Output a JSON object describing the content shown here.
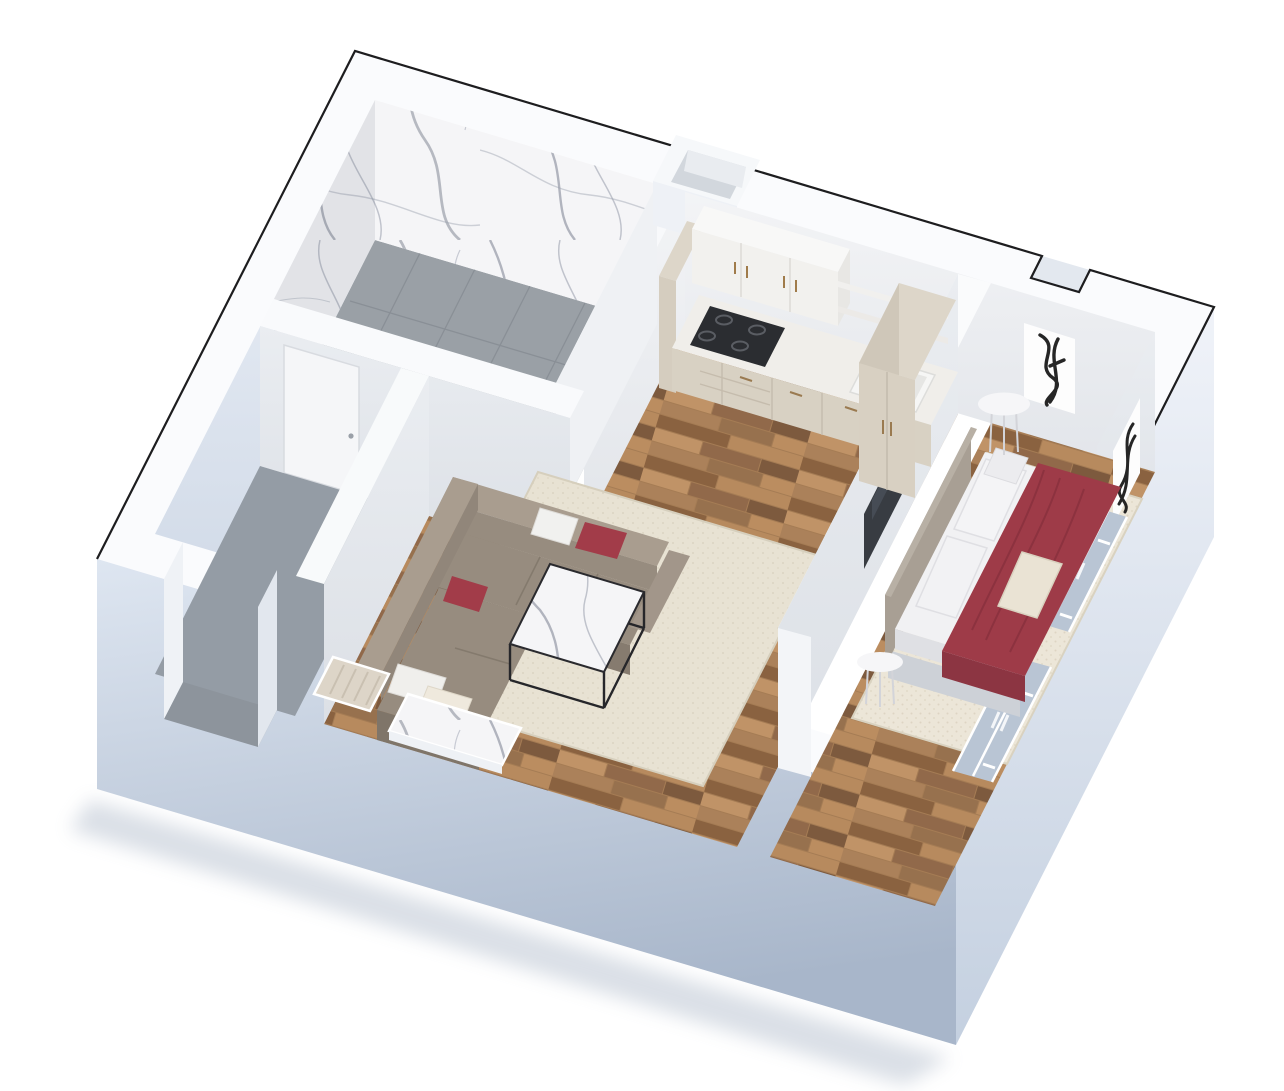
{
  "scene": {
    "type": "isometric-3d-floor-plan",
    "description": "Cutaway bird's-eye 3D floor plan of a one-bedroom apartment",
    "rooms": [
      {
        "name": "bathroom",
        "position": "top-left",
        "features": [
          "marble-clad-walls",
          "grey-stone-floor",
          "stone-shower-bench",
          "toilet",
          "washbasin",
          "white-door"
        ]
      },
      {
        "name": "entry-vestibule",
        "position": "bottom-left",
        "features": [
          "concrete-floor",
          "entry-opening-in-outer-wall",
          "interior-door"
        ]
      },
      {
        "name": "living-room",
        "position": "center",
        "features": [
          "parquet-floor",
          "beige-area-rug",
          "corner-sofa",
          "red-accent-pillows",
          "white-pillows",
          "marble-top-coffee-table",
          "wall-mounted-tv",
          "window-with-marble-sill",
          "window-with-radiator"
        ]
      },
      {
        "name": "kitchen",
        "position": "top-center",
        "features": [
          "beige-base-cabinets",
          "white-counter",
          "gas-cooktop",
          "double-sink",
          "white-upper-cabinets",
          "open-shelves",
          "tall-beige-cabinet",
          "beige-wardrobe-cabinet"
        ]
      },
      {
        "name": "bedroom",
        "position": "right",
        "features": [
          "double-bed",
          "white-bedding",
          "dark-red-throw-blanket",
          "beige-accent-pillow",
          "taupe-upholstered-headboard",
          "round-side-table-top",
          "round-side-table-bottom",
          "beige-area-rug",
          "abstract-ink-artwork-left",
          "abstract-ink-artwork-right",
          "casement-windows",
          "duct-shaft-on-top-wall",
          "wall-top-outline-notch"
        ]
      }
    ]
  },
  "colors": {
    "background": "#ffffff",
    "outline": "#1d1d1f",
    "wall_top": "#fafbfd",
    "wall_face_light": "#eef2f8",
    "wall_face_mid": "#ccd7e5",
    "wall_face_dark": "#a5b2c6",
    "interior_wall": "#edeff3",
    "interior_wall_shaded": "#e0e4ea",
    "marble_base": "#f5f5f7",
    "marble_vein": "#787e8a",
    "stone_floor": "#9aa0a6",
    "entry_floor": "#949ca5",
    "wood_base": "#a57c54",
    "rug_living": "#e8e2d3",
    "rug_bedroom": "#ece6d8",
    "sofa": "#978c7f",
    "sofa_dark": "#7f7569",
    "sofa_light": "#a99d8f",
    "accent_red": "#a23c49",
    "blanket_red": "#9e3b48",
    "bedding_white": "#f1f1f3",
    "headboard": "#a89f94",
    "platform_grey": "#cdd1d7",
    "cabinet_beige": "#d8d1c3",
    "cabinet_beige_dark": "#cfc7b9",
    "cabinet_white": "#f2f1ee",
    "counter": "#f0eeea",
    "cooktop": "#2b2d31",
    "tv": "#383c42",
    "glass": "#b9c5d4",
    "artwork_canvas": "#fdfdfd",
    "artwork_ink": "#141414",
    "table_white": "#f6f6f8",
    "radiator_beige": "#ddd5c8"
  }
}
